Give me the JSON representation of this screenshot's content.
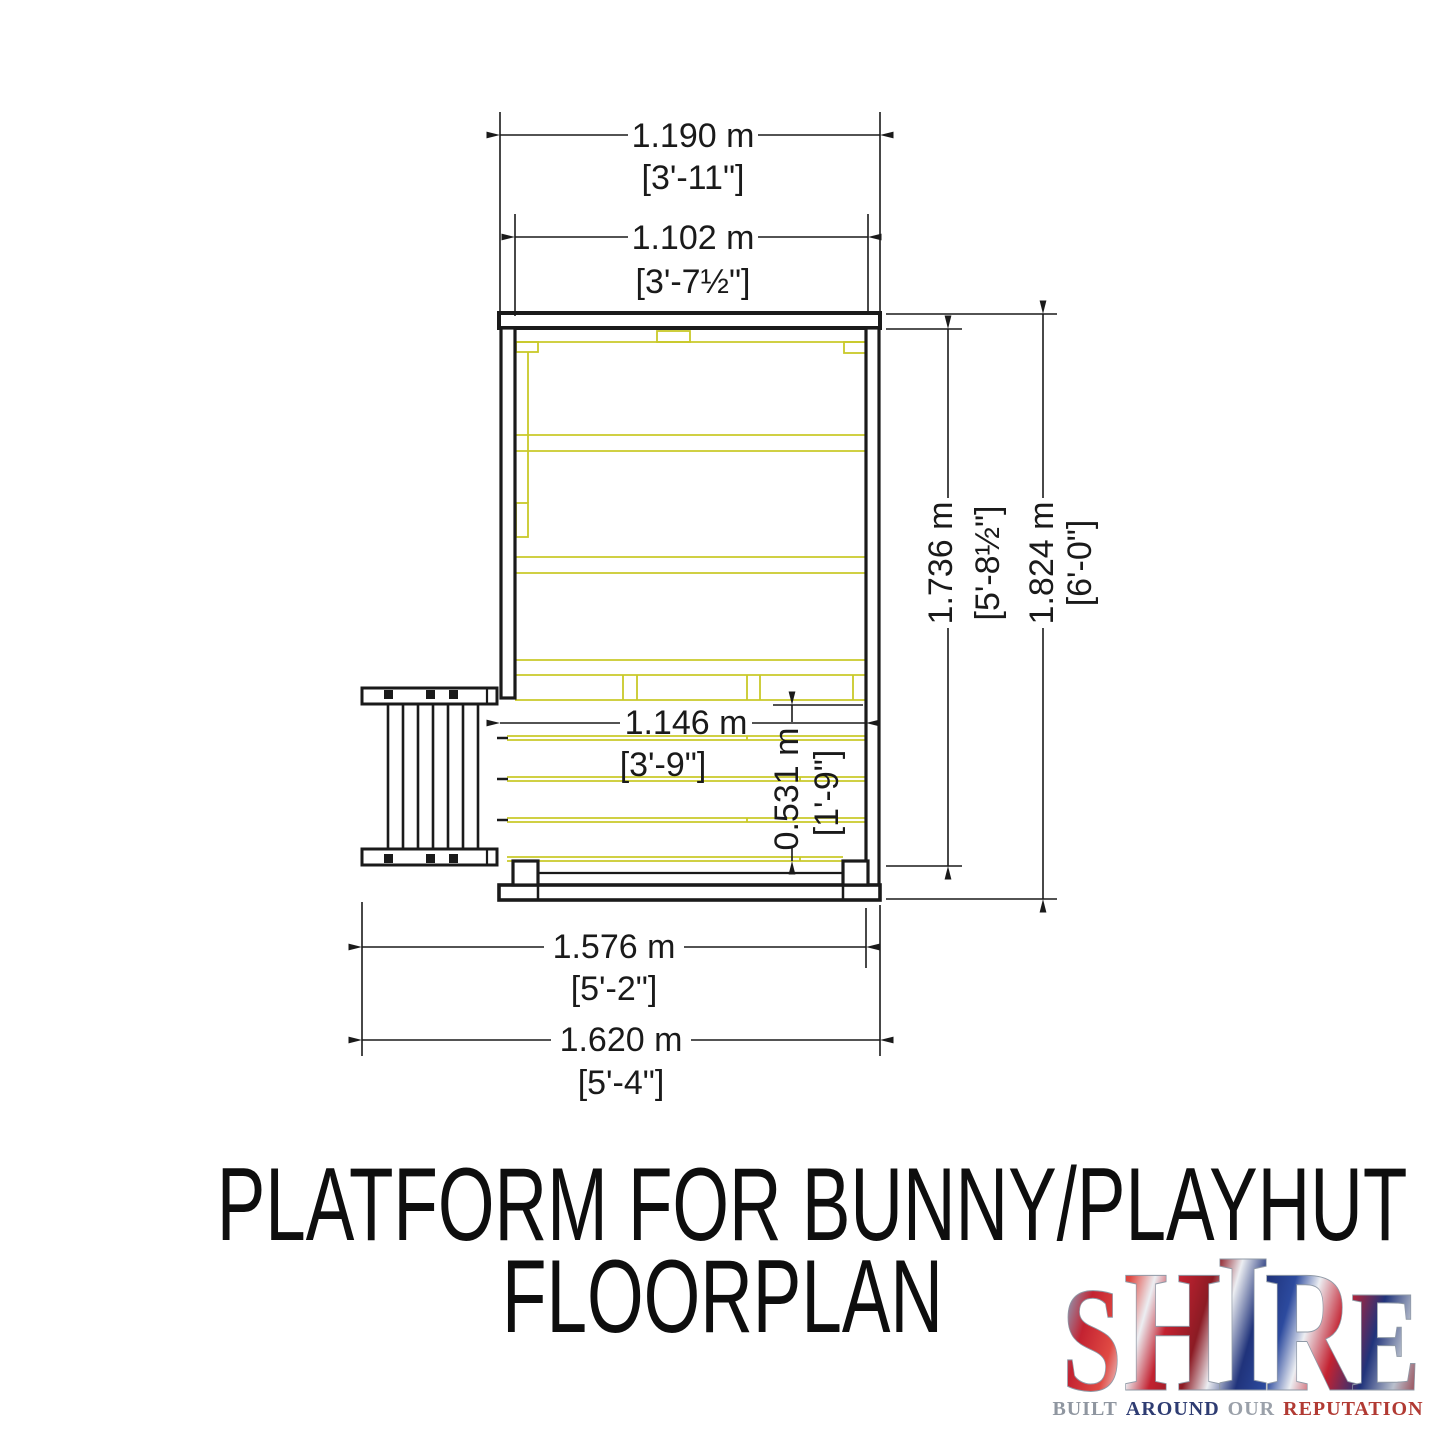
{
  "drawing": {
    "colors": {
      "outline": "#1a1a1a",
      "timber": "#c9c929"
    },
    "dimensions": {
      "top_outer": {
        "metric": "1.190 m",
        "imperial": "[3'-11\"]"
      },
      "top_inner": {
        "metric": "1.102 m",
        "imperial": "[3'-7½\"]"
      },
      "right_inner": {
        "metric": "1.736 m",
        "imperial": "[5'-8½\"]"
      },
      "right_outer": {
        "metric": "1.824 m",
        "imperial": "[6'-0\"]"
      },
      "deck_width": {
        "metric": "1.146 m",
        "imperial": "[3'-9\"]"
      },
      "deck_depth": {
        "metric": "0.531 m",
        "imperial": "[1'-9\"]"
      },
      "bottom_inner": {
        "metric": "1.576 m",
        "imperial": "[5'-2\"]"
      },
      "bottom_outer": {
        "metric": "1.620 m",
        "imperial": "[5'-4\"]"
      }
    }
  },
  "title": {
    "line1": "PLATFORM FOR BUNNY/PLAYHUT",
    "line2": "FLOORPLAN"
  },
  "logo": {
    "letters": [
      "S",
      "H",
      "I",
      "R",
      "E"
    ],
    "tagline_words": [
      "BUILT",
      "AROUND",
      "OUR",
      "REPUTATION"
    ],
    "flag_red": "#c32231",
    "flag_blue": "#20337b",
    "flag_silver": "#eceef2"
  }
}
